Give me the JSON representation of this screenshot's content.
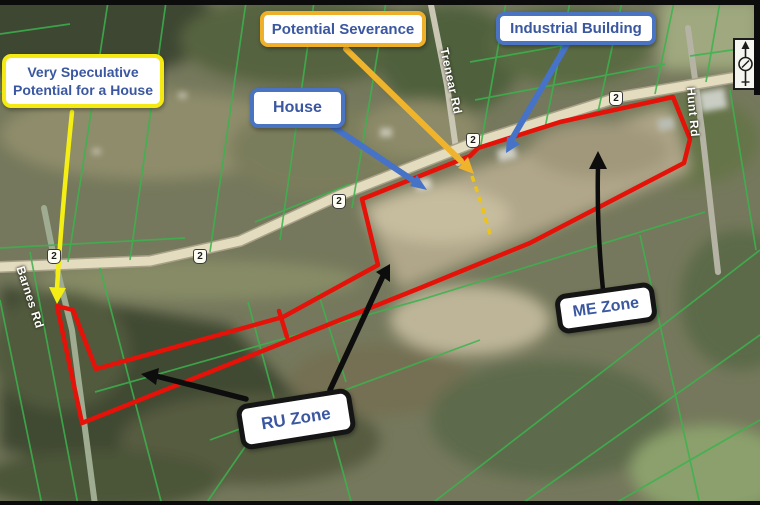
{
  "map": {
    "callouts": {
      "very_speculative": "Very Speculative Potential for a House",
      "potential_severance": "Potential Severance",
      "house": "House",
      "industrial_building": "Industrial Building"
    },
    "zones": {
      "me": "ME Zone",
      "ru": "RU Zone"
    },
    "roads": {
      "trenear": "Trenear Rd",
      "hunt": "Hunt Rd",
      "barnes": "Barnes Rd"
    },
    "highway_shield": "2",
    "colors": {
      "boundary_red": "#e41208",
      "parcel_line_green": "#3cb34e",
      "severance_dash_yellow": "#ecc418",
      "callout_border_yellow": "#f4e913",
      "callout_border_gold": "#eeb02a",
      "callout_border_blue": "#4a73c2",
      "callout_text_blue": "#3a57a0"
    }
  }
}
